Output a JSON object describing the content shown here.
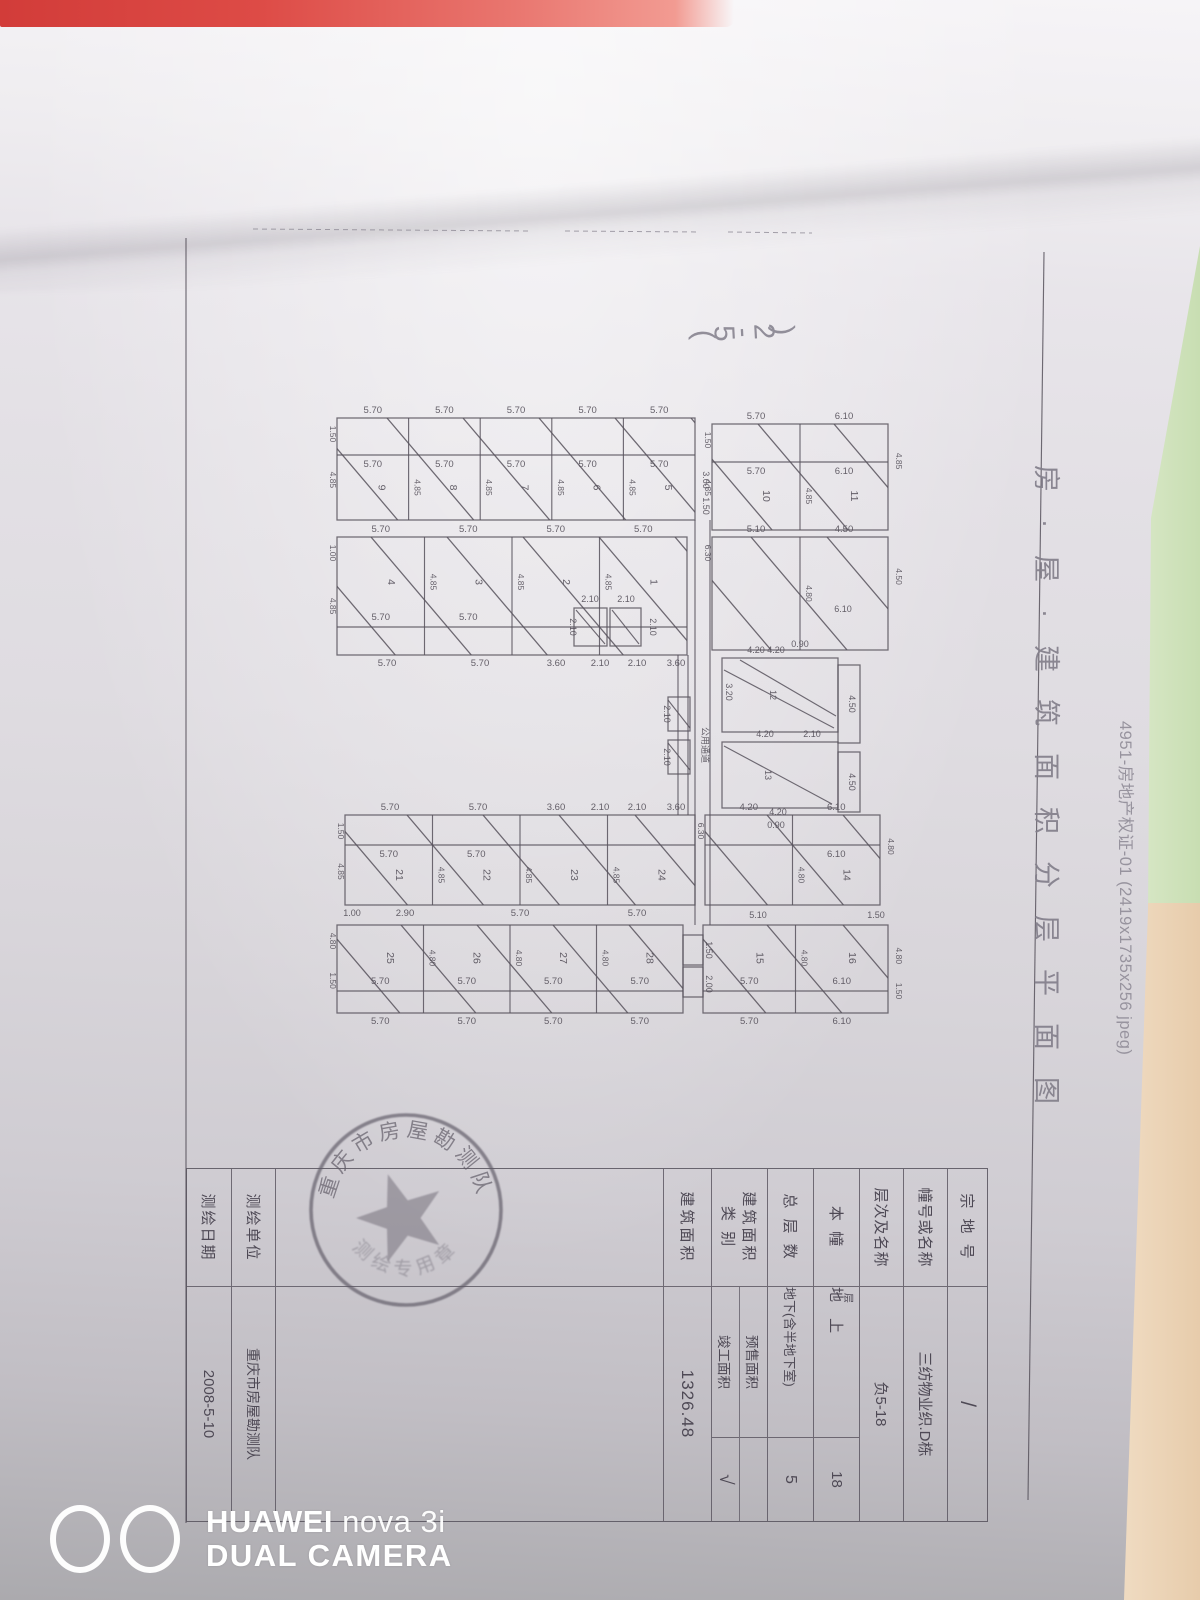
{
  "photo": {
    "pink_strip_color": "#dc4340",
    "green_strip_color": "#cde1b9",
    "peach_strip_color": "#ecd5ba"
  },
  "side_note": "4951-房地产权证-01 (2419x1735x256 jpeg)",
  "handwritten_note": "(5-2)",
  "watermark": {
    "brand": "HUAWEI",
    "model": "nova 3i",
    "line2": "DUAL CAMERA"
  },
  "document": {
    "title": "房·屋·建筑面积分层平面图",
    "stamp": {
      "arc_top": "重庆市房屋勘测队",
      "arc_bottom": "测绘专用章"
    },
    "title_block": {
      "r1": {
        "label": "宗 地 号",
        "value": "/"
      },
      "r2": {
        "label": "幢号或名称",
        "value": "三纺物业织.D栋"
      },
      "r3": {
        "label": "本    幢",
        "sub": "层"
      },
      "r2b": {
        "label": "层次及名称",
        "value": "负5-18"
      },
      "r4": {
        "value": "地  上",
        "num": "18"
      },
      "r5": {
        "label": "总 层 数",
        "value": "地下(含半地下室)",
        "num": "5"
      },
      "r6": {
        "label1": "建筑面积",
        "label2": "类    别",
        "value1": "预售面积",
        "value2": "竣工面积",
        "check": "√"
      },
      "r7": {
        "label": "建筑面积",
        "value": "1326.48"
      },
      "r9": {
        "label": "测绘单位",
        "value": "重庆市房屋勘测队"
      },
      "r10": {
        "label": "测绘日期",
        "value": "2008-5-10"
      }
    }
  },
  "floor_plan": {
    "ink": "#58535d",
    "bands": [
      {
        "x": 337,
        "y": 418,
        "w": 358,
        "h": 102,
        "strip": "top",
        "stripH": 37,
        "cells": 5,
        "top_dims": [
          "5.70",
          "5.70",
          "5.70",
          "5.70",
          "5.70"
        ],
        "mid_dims": [
          "5.70",
          "5.70",
          "5.70",
          "5.70",
          "5.70"
        ],
        "units": [
          "9",
          "8",
          "7",
          "6",
          "5"
        ],
        "left_dims": [
          "1.50",
          "4.85"
        ],
        "side_dim": "4.85"
      },
      {
        "x": 712,
        "y": 424,
        "w": 176,
        "h": 106,
        "strip": "top",
        "stripH": 38,
        "cells": 2,
        "top_dims": [
          "5.70",
          "6.10"
        ],
        "mid_dims": [
          "5.70",
          "6.10"
        ],
        "units": [
          "10",
          "11"
        ],
        "left_dims": [
          "1.50",
          "4.85"
        ],
        "side_dim": "4.85",
        "right_dims": [
          "4.85"
        ]
      },
      {
        "x": 337,
        "y": 537,
        "w": 350,
        "h": 118,
        "strip": "bottom",
        "stripH": 28,
        "cells": 4,
        "top_dims": [
          "5.70",
          "5.70",
          "5.70",
          "5.70"
        ],
        "mid_dims": [
          "5.70",
          "5.70"
        ],
        "units": [
          "4",
          "3",
          "2",
          "1"
        ],
        "left_dims": [
          "1.00",
          "4.85"
        ],
        "side_dim": "4.85",
        "bottom_dims": [
          "5.70",
          "5.70",
          "3.60",
          "2.10",
          "2.10",
          "3.60"
        ],
        "bottom_dims_x": [
          387,
          480,
          556,
          600,
          637,
          676
        ]
      },
      {
        "x": 712,
        "y": 537,
        "w": 176,
        "h": 113,
        "cells": 2,
        "top_dims": [
          "5.10",
          "4.50"
        ],
        "units": [
          "",
          ""
        ],
        "left_dims": [
          "6.30"
        ],
        "side_dim": "4.80",
        "right_dims": [
          "4.50"
        ]
      },
      {
        "x": 345,
        "y": 815,
        "w": 350,
        "h": 90,
        "strip": "top",
        "stripH": 30,
        "cells": 4,
        "top_dims": [
          "5.70",
          "5.70",
          "3.60",
          "2.10",
          "2.10",
          "3.60"
        ],
        "top_dims_x": [
          390,
          478,
          556,
          600,
          637,
          676
        ],
        "mid_dims": [
          "5.70",
          "5.70"
        ],
        "units": [
          "21",
          "22",
          "23",
          "24"
        ],
        "left_dims": [
          "1.50",
          "4.85"
        ],
        "side_dim": "4.85",
        "bottom_dims": [
          "2.90",
          "5.70",
          "5.70"
        ],
        "bottom_dims_x": [
          405,
          520,
          637
        ]
      },
      {
        "x": 705,
        "y": 815,
        "w": 175,
        "h": 90,
        "strip": "top",
        "stripH": 30,
        "cells": 2,
        "top_dims": [
          "4.20",
          "6.10"
        ],
        "mid_dims": [
          "",
          "6.10"
        ],
        "units": [
          "",
          "14"
        ],
        "left_dims": [
          "6.30"
        ],
        "side_dim": "4.80",
        "right_dims": [
          "4.80"
        ]
      },
      {
        "x": 337,
        "y": 925,
        "w": 346,
        "h": 88,
        "strip": "bottom",
        "stripH": 22,
        "cells": 4,
        "mid_dims": [
          "5.70",
          "5.70",
          "5.70",
          "5.70"
        ],
        "units": [
          "25",
          "26",
          "27",
          "28"
        ],
        "left_dims": [
          "4.80",
          "1.50"
        ],
        "side_dim": "4.80",
        "bottom_dims": [
          "5.70",
          "5.70",
          "5.70",
          "5.70"
        ]
      },
      {
        "x": 703,
        "y": 925,
        "w": 185,
        "h": 88,
        "strip": "bottom",
        "stripH": 22,
        "cells": 2,
        "mid_dims": [
          "5.70",
          "6.10"
        ],
        "units": [
          "15",
          "16"
        ],
        "side_dim": "4.80",
        "right_dims": [
          "4.80",
          "1.50"
        ],
        "bottom_dims": [
          "5.70",
          "6.10"
        ]
      }
    ],
    "extra_rects": [
      [
        574,
        608,
        33,
        38
      ],
      [
        610,
        608,
        31,
        38
      ],
      [
        668,
        697,
        22,
        34
      ],
      [
        668,
        740,
        22,
        34
      ],
      [
        722,
        658,
        116,
        74
      ],
      [
        838,
        665,
        22,
        78
      ],
      [
        722,
        742,
        116,
        66
      ],
      [
        838,
        752,
        22,
        60
      ],
      [
        683,
        935,
        20,
        30
      ],
      [
        683,
        967,
        20,
        30
      ]
    ],
    "extra_lines": [
      [
        695,
        520,
        695,
        925
      ],
      [
        710,
        520,
        710,
        925
      ],
      [
        678,
        655,
        678,
        815
      ],
      [
        688,
        655,
        688,
        815
      ],
      [
        186,
        238,
        186,
        1523
      ],
      [
        1044,
        252,
        1028,
        1500
      ],
      [
        724,
        670,
        834,
        728
      ],
      [
        740,
        660,
        836,
        716
      ],
      [
        724,
        746,
        832,
        804
      ],
      [
        668,
        700,
        690,
        728
      ],
      [
        668,
        743,
        690,
        770
      ],
      [
        576,
        610,
        605,
        644
      ],
      [
        612,
        610,
        639,
        644
      ]
    ],
    "frame_dash": [
      [
        253,
        229,
        530,
        231
      ],
      [
        565,
        231,
        700,
        232
      ],
      [
        728,
        232,
        812,
        233
      ]
    ],
    "extra_labels": [
      [
        756,
        653,
        "4.20",
        0
      ],
      [
        843,
        612,
        "6.10",
        0
      ],
      [
        800,
        647,
        "0.90",
        0
      ],
      [
        776,
        653,
        "4.20",
        0
      ],
      [
        765,
        737,
        "4.20",
        0
      ],
      [
        812,
        737,
        "2.10",
        0
      ],
      [
        778,
        815,
        "4.20",
        0
      ],
      [
        849,
        704,
        "4.50",
        90
      ],
      [
        849,
        782,
        "4.50",
        90
      ],
      [
        726,
        692,
        "3.20",
        90
      ],
      [
        770,
        695,
        "12",
        90
      ],
      [
        765,
        775,
        "13",
        90
      ],
      [
        664,
        714,
        "2.10",
        90
      ],
      [
        664,
        757,
        "2.10",
        90
      ],
      [
        590,
        602,
        "2.10",
        0
      ],
      [
        626,
        602,
        "2.10",
        0
      ],
      [
        570,
        627,
        "2.10",
        90
      ],
      [
        650,
        627,
        "2.10",
        90
      ],
      [
        703,
        480,
        "3.00",
        90
      ],
      [
        703,
        506,
        "1.50",
        90
      ],
      [
        702,
        745,
        "公用通道",
        90
      ],
      [
        706,
        950,
        "1.50",
        90
      ],
      [
        706,
        984,
        "2.00",
        90
      ],
      [
        352,
        916,
        "1.00",
        0
      ],
      [
        758,
        918,
        "5.10",
        0
      ],
      [
        876,
        918,
        "1.50",
        0
      ],
      [
        776,
        828,
        "0.90",
        0
      ]
    ]
  }
}
